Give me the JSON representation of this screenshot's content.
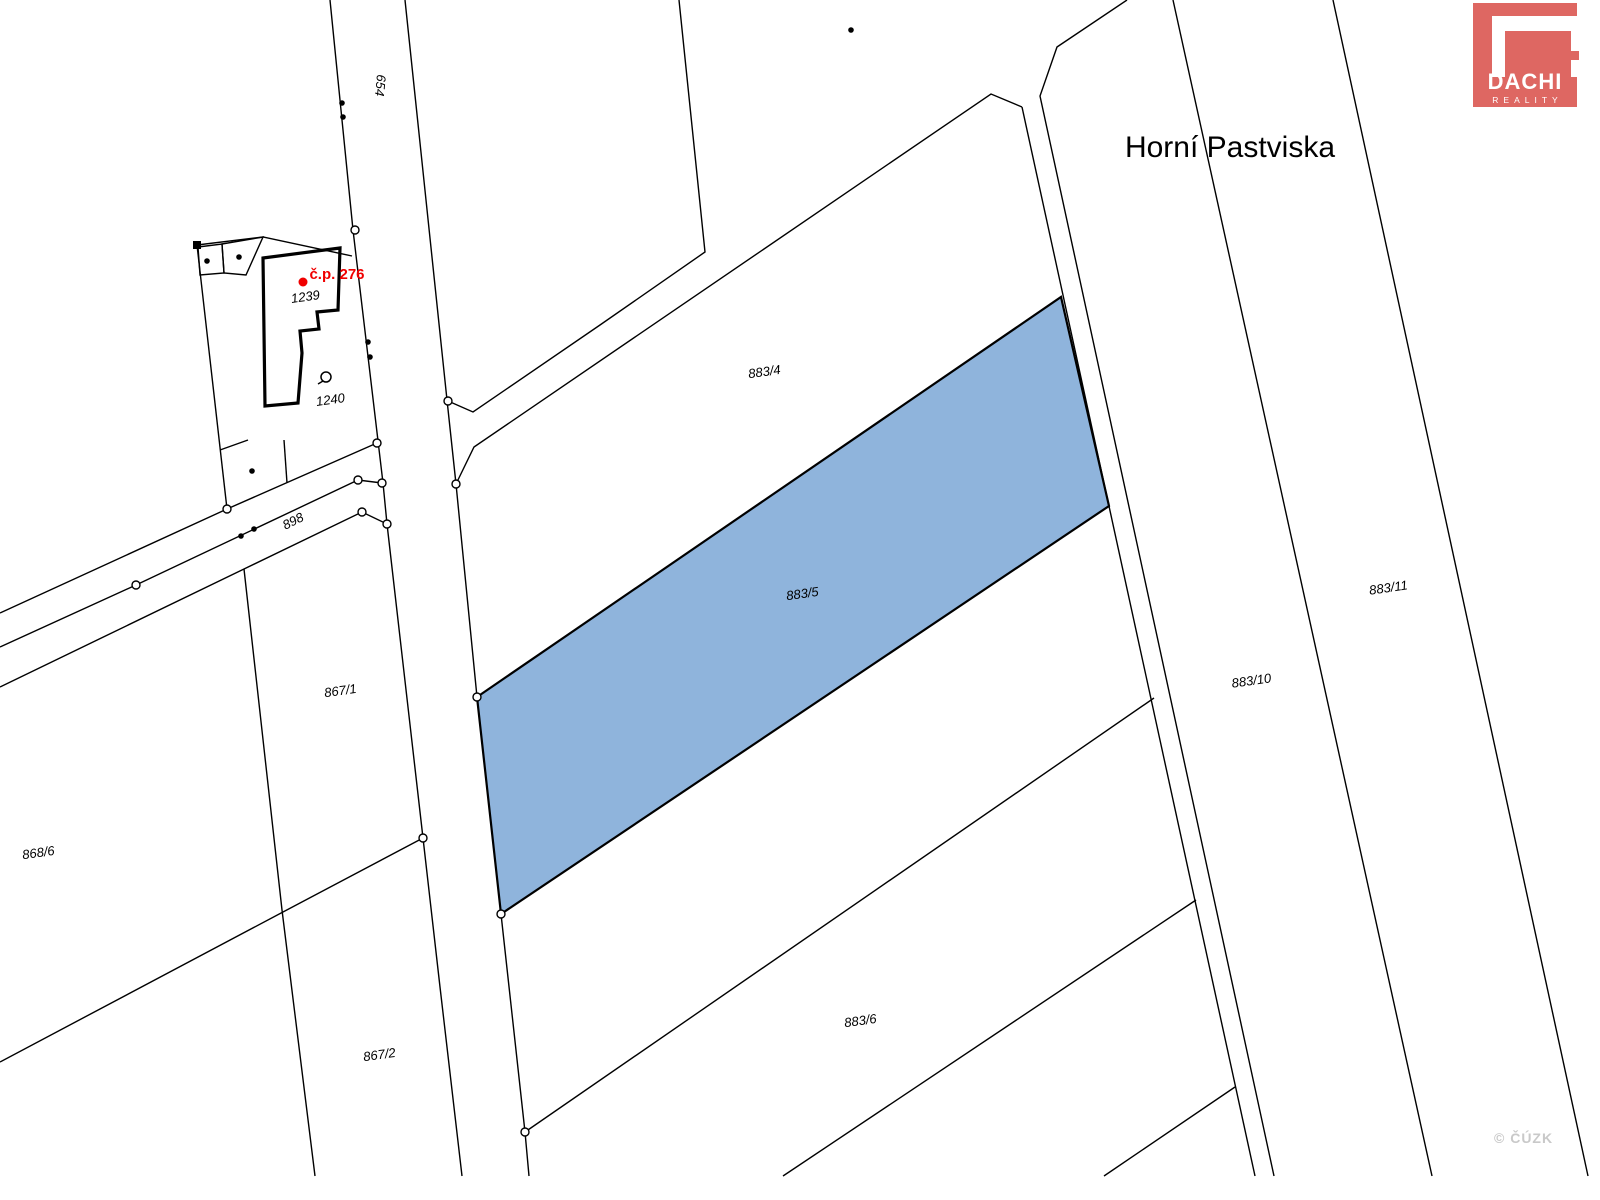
{
  "map": {
    "width": 1600,
    "height": 1200,
    "background": "#ffffff",
    "line_color": "#000000",
    "line_width": 1.4,
    "highlight": {
      "parcel": "883/5",
      "fill": "#8FB4DC",
      "stroke": "#000000",
      "stroke_width": 2.2
    },
    "polygons": [
      {
        "name": "highlighted-parcel-883-5",
        "interactable": true,
        "points": [
          [
            477,
            697
          ],
          [
            1061,
            297
          ],
          [
            1109,
            506
          ],
          [
            501,
            914
          ]
        ],
        "fill": "#8FB4DC",
        "stroke": "#000000",
        "width": 2.2
      },
      {
        "name": "building-footprint-cp276",
        "points": [
          [
            263,
            258
          ],
          [
            340,
            248
          ],
          [
            338,
            310
          ],
          [
            317,
            312
          ],
          [
            319,
            329
          ],
          [
            300,
            331
          ],
          [
            302,
            353
          ],
          [
            298,
            403
          ],
          [
            265,
            406
          ]
        ],
        "fill": "none",
        "stroke": "#000000",
        "width": 3.2
      },
      {
        "name": "small-building-1",
        "points": [
          [
            198,
            247
          ],
          [
            222,
            244
          ],
          [
            224,
            273
          ],
          [
            200,
            275
          ]
        ],
        "fill": "none",
        "stroke": "#000000",
        "width": 1.4
      },
      {
        "name": "small-building-2",
        "points": [
          [
            222,
            244
          ],
          [
            263,
            237
          ],
          [
            246,
            275
          ],
          [
            224,
            273
          ]
        ],
        "fill": "none",
        "stroke": "#000000",
        "width": 1.4
      }
    ],
    "lines": [
      {
        "name": "road-654-left-edge",
        "points": [
          [
            330,
            0
          ],
          [
            353,
            230
          ],
          [
            383,
            483
          ],
          [
            387,
            524
          ],
          [
            423,
            838
          ],
          [
            440,
            987
          ],
          [
            462,
            1176
          ]
        ]
      },
      {
        "name": "road-654-right-edge",
        "points": [
          [
            405,
            0
          ],
          [
            447,
            400
          ],
          [
            456,
            484
          ],
          [
            477,
            697
          ],
          [
            501,
            914
          ],
          [
            525,
            1132
          ],
          [
            529,
            1176
          ]
        ]
      },
      {
        "name": "north-parcel-west-boundary",
        "points": [
          [
            448,
            401
          ],
          [
            473,
            412
          ],
          [
            600,
            325
          ],
          [
            705,
            252
          ],
          [
            679,
            0
          ]
        ]
      },
      {
        "name": "parcel-883-4-north-boundary",
        "points": [
          [
            456,
            484
          ],
          [
            474,
            447
          ],
          [
            991,
            94
          ],
          [
            1022,
            107
          ]
        ]
      },
      {
        "name": "strip-west-line",
        "points": [
          [
            1022,
            107
          ],
          [
            1255,
            1176
          ]
        ]
      },
      {
        "name": "parcel-883-10-west-boundary",
        "points": [
          [
            1127,
            0
          ],
          [
            1057,
            47
          ],
          [
            1040,
            96
          ],
          [
            1274,
            1176
          ]
        ]
      },
      {
        "name": "parcel-883-10-east-boundary",
        "points": [
          [
            1173,
            0
          ],
          [
            1432,
            1176
          ]
        ]
      },
      {
        "name": "parcel-883-11-east-boundary",
        "points": [
          [
            1333,
            0
          ],
          [
            1588,
            1176
          ]
        ]
      },
      {
        "name": "parcel-883-6-north-boundary",
        "points": [
          [
            525,
            1132
          ],
          [
            1154,
            698
          ]
        ]
      },
      {
        "name": "parcel-883-6-south-boundary",
        "points": [
          [
            783,
            1176
          ],
          [
            1196,
            900
          ]
        ]
      },
      {
        "name": "lower-strip-boundary",
        "points": [
          [
            1104,
            1176
          ],
          [
            1235,
            1087
          ]
        ]
      },
      {
        "name": "path-898-north-line",
        "points": [
          [
            0,
            613
          ],
          [
            227,
            509
          ],
          [
            377,
            443
          ]
        ]
      },
      {
        "name": "path-898-middle-line",
        "points": [
          [
            0,
            647
          ],
          [
            136,
            585
          ],
          [
            358,
            480
          ],
          [
            382,
            483
          ]
        ]
      },
      {
        "name": "path-898-south-line",
        "points": [
          [
            0,
            687
          ],
          [
            244,
            569
          ],
          [
            362,
            512
          ],
          [
            387,
            524
          ]
        ]
      },
      {
        "name": "boundary-868-6-867-1",
        "points": [
          [
            244,
            569
          ],
          [
            282,
            910
          ],
          [
            315,
            1176
          ]
        ]
      },
      {
        "name": "boundary-867-1-867-2",
        "points": [
          [
            0,
            1062
          ],
          [
            283,
            912
          ],
          [
            423,
            838
          ]
        ]
      },
      {
        "name": "garden-block-north-edge",
        "points": [
          [
            197,
            245
          ],
          [
            263,
            237
          ],
          [
            352,
            256
          ]
        ]
      },
      {
        "name": "garden-block-west-edge",
        "points": [
          [
            197,
            245
          ],
          [
            227,
            509
          ]
        ]
      },
      {
        "name": "garden-wedge-line-1",
        "points": [
          [
            220,
            450
          ],
          [
            248,
            440
          ]
        ]
      },
      {
        "name": "garden-wedge-line-2",
        "points": [
          [
            284,
            440
          ],
          [
            287,
            483
          ]
        ]
      },
      {
        "name": "map-symbol-tail",
        "points": [
          [
            318,
            384
          ],
          [
            323,
            381
          ]
        ]
      }
    ],
    "markers": {
      "open_circles": [
        [
          355,
          230
        ],
        [
          448,
          401
        ],
        [
          456,
          484
        ],
        [
          477,
          697
        ],
        [
          501,
          914
        ],
        [
          525,
          1132
        ],
        [
          423,
          838
        ],
        [
          377,
          443
        ],
        [
          382,
          483
        ],
        [
          387,
          524
        ],
        [
          362,
          512
        ],
        [
          358,
          480
        ],
        [
          227,
          509
        ],
        [
          136,
          585
        ]
      ],
      "open_circle_radius": 4,
      "dots": [
        [
          342,
          103
        ],
        [
          343,
          117
        ],
        [
          368,
          342
        ],
        [
          370,
          357
        ],
        [
          207,
          261
        ],
        [
          239,
          257
        ],
        [
          252,
          471
        ],
        [
          851,
          30
        ],
        [
          241,
          536
        ],
        [
          254,
          529
        ]
      ],
      "dot_radius": 2.8,
      "corner_square": {
        "x": 197,
        "y": 245,
        "size": 8
      },
      "red_point": {
        "x": 303,
        "y": 282,
        "radius": 4.5,
        "color": "#f00000"
      },
      "symbol_circle": {
        "x": 326,
        "y": 377,
        "radius": 5
      }
    },
    "labels": [
      {
        "name": "road-label-654",
        "text": "654",
        "x": 376,
        "y": 85,
        "size": 13,
        "rotate": 95,
        "italic": true,
        "color": "#000000"
      },
      {
        "name": "building-number-label",
        "text": "č.p. 276",
        "x": 337,
        "y": 279,
        "size": 15,
        "rotate": 0,
        "italic": false,
        "bold": true,
        "color": "#f00000"
      },
      {
        "name": "parcel-label-1239",
        "text": "1239",
        "x": 306,
        "y": 301,
        "size": 13,
        "rotate": -8,
        "italic": true,
        "color": "#000000"
      },
      {
        "name": "parcel-label-1240",
        "text": "1240",
        "x": 331,
        "y": 404,
        "size": 13,
        "rotate": -8,
        "italic": true,
        "color": "#000000"
      },
      {
        "name": "parcel-label-898",
        "text": "898",
        "x": 295,
        "y": 525,
        "size": 13,
        "rotate": -27,
        "italic": true,
        "color": "#000000"
      },
      {
        "name": "parcel-label-868-6",
        "text": "868/6",
        "x": 39,
        "y": 857,
        "size": 13,
        "rotate": -8,
        "italic": true,
        "color": "#000000"
      },
      {
        "name": "parcel-label-867-1",
        "text": "867/1",
        "x": 341,
        "y": 695,
        "size": 13,
        "rotate": -8,
        "italic": true,
        "color": "#000000"
      },
      {
        "name": "parcel-label-867-2",
        "text": "867/2",
        "x": 380,
        "y": 1059,
        "size": 13,
        "rotate": -8,
        "italic": true,
        "color": "#000000"
      },
      {
        "name": "parcel-label-883-4",
        "text": "883/4",
        "x": 765,
        "y": 376,
        "size": 13,
        "rotate": -8,
        "italic": true,
        "color": "#000000"
      },
      {
        "name": "parcel-label-883-5",
        "text": "883/5",
        "x": 803,
        "y": 598,
        "size": 13,
        "rotate": -8,
        "italic": true,
        "color": "#000000"
      },
      {
        "name": "parcel-label-883-6",
        "text": "883/6",
        "x": 861,
        "y": 1025,
        "size": 13,
        "rotate": -8,
        "italic": true,
        "color": "#000000"
      },
      {
        "name": "parcel-label-883-10",
        "text": "883/10",
        "x": 1252,
        "y": 685,
        "size": 13,
        "rotate": -8,
        "italic": true,
        "color": "#000000"
      },
      {
        "name": "parcel-label-883-11",
        "text": "883/11",
        "x": 1389,
        "y": 592,
        "size": 13,
        "rotate": -8,
        "italic": true,
        "color": "#000000"
      },
      {
        "name": "locality-label",
        "text": "Horní Pastviska",
        "x": 1230,
        "y": 157,
        "size": 30,
        "rotate": 0,
        "italic": false,
        "color": "#000000"
      }
    ]
  },
  "logo": {
    "name": "DACHI",
    "subtitle": "REALITY",
    "background": "#DE6762",
    "foreground": "#ffffff"
  },
  "watermark": {
    "text": "© ČÚZK",
    "color": "#c9c9c9"
  }
}
